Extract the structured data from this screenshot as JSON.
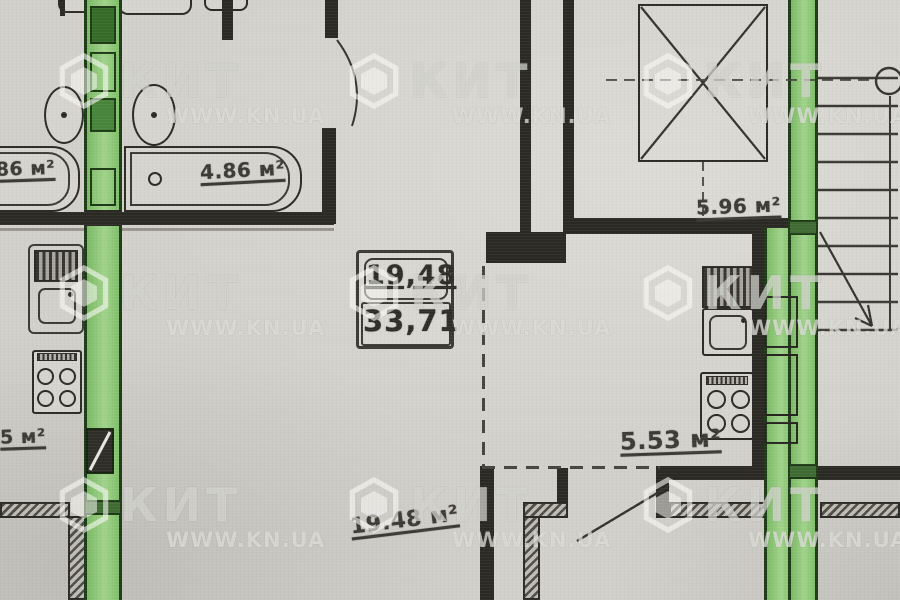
{
  "meta": {
    "type": "apartment-floor-plan-photo"
  },
  "colors": {
    "paper": "#d2d0ca",
    "wall": "#2a2923",
    "green_fill": "#8cc474",
    "green_border": "#1d3a16",
    "label_text": "#3c3b33",
    "watermark": "rgba(250,250,246,0.6)"
  },
  "watermark": {
    "brand": "КИТ",
    "url": "WWW.KN.UA"
  },
  "labels": {
    "bath_left_partial": ".86 м²",
    "bath_right": "4.86 м²",
    "elevator_room": "5.96 м²",
    "kitchen": "5.53 м²",
    "living_room": "19.48 м²",
    "left_room_partial": "5 м²"
  },
  "area_box": {
    "upper": "19,48",
    "lower": "33,71"
  },
  "fixtures": [
    "bathtub",
    "washing-machine",
    "toilet",
    "kitchen-sink",
    "stove",
    "elevator",
    "stairs"
  ]
}
